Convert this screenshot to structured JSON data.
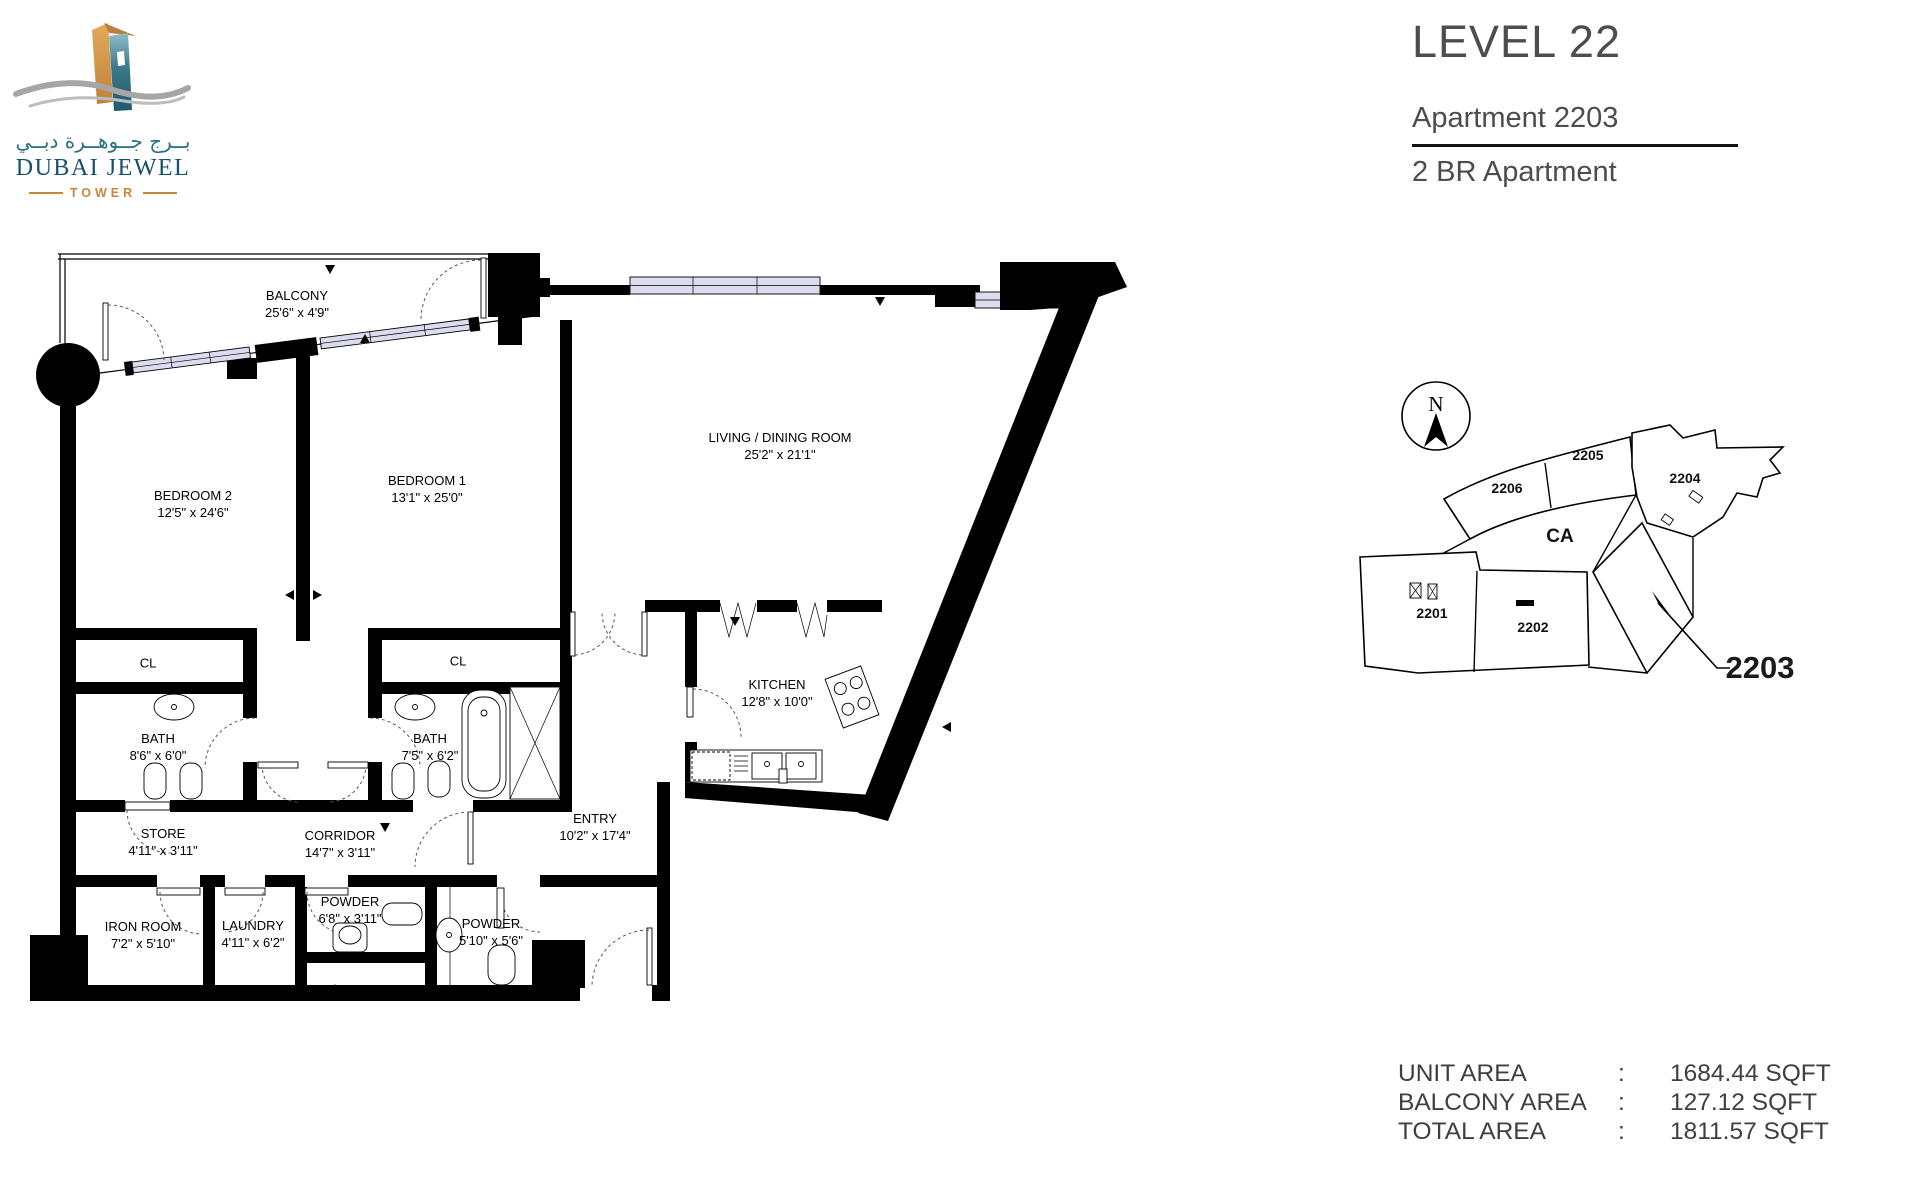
{
  "logo": {
    "arabic": "بــرج جــوهــرة دبــي",
    "title": "DUBAI JEWEL",
    "subtitle": "TOWER"
  },
  "header": {
    "level": "LEVEL 22",
    "apartment": "Apartment 2203",
    "type": "2 BR Apartment"
  },
  "rooms": [
    {
      "name": "BALCONY",
      "dims": "25'6\" x 4'9\""
    },
    {
      "name": "BEDROOM 2",
      "dims": "12'5\" x 24'6\""
    },
    {
      "name": "BEDROOM 1",
      "dims": "13'1\" x 25'0\""
    },
    {
      "name": "LIVING / DINING ROOM",
      "dims": "25'2\" x 21'1\""
    },
    {
      "name": "CL",
      "dims": ""
    },
    {
      "name": "CL",
      "dims": ""
    },
    {
      "name": "BATH",
      "dims": "8'6\" x 6'0\""
    },
    {
      "name": "BATH",
      "dims": "7'5\" x 6'2\""
    },
    {
      "name": "KITCHEN",
      "dims": "12'8\" x 10'0\""
    },
    {
      "name": "STORE",
      "dims": "4'11\" x 3'11\""
    },
    {
      "name": "CORRIDOR",
      "dims": "14'7\" x 3'11\""
    },
    {
      "name": "ENTRY",
      "dims": "10'2\" x 17'4\""
    },
    {
      "name": "IRON ROOM",
      "dims": "7'2\" x 5'10\""
    },
    {
      "name": "LAUNDRY",
      "dims": "4'11\" x 6'2\""
    },
    {
      "name": "POWDER",
      "dims": "6'8\" x 3'11\""
    },
    {
      "name": "POWDER",
      "dims": "5'10\" x 5'6\""
    }
  ],
  "key_plan": {
    "north": "N",
    "units": [
      "2206",
      "2205",
      "2204",
      "2201",
      "2202"
    ],
    "common_area": "CA",
    "highlighted_unit": "2203"
  },
  "areas": {
    "rows": [
      {
        "label": "UNIT AREA",
        "sep": ":",
        "value": "1684.44 SQFT"
      },
      {
        "label": "BALCONY AREA",
        "sep": ":",
        "value": "127.12 SQFT"
      },
      {
        "label": "TOTAL AREA",
        "sep": ":",
        "value": "1811.57 SQFT"
      }
    ]
  },
  "colors": {
    "logo_teal": "#2a7286",
    "logo_dark_teal": "#17506a",
    "logo_orange": "#c8873c",
    "wave_gray": "#a6a6a6",
    "glazing": "#dcdcef",
    "title_gray": "#4d4d4f",
    "line_black": "#000000"
  }
}
